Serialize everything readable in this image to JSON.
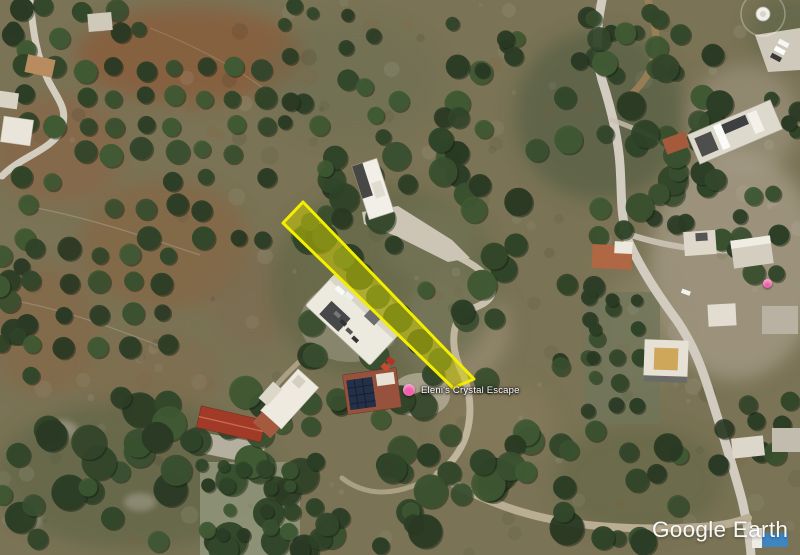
{
  "watermark": {
    "text": "Google Earth"
  },
  "labels": {
    "property": {
      "text": "Eleni's Crystal Escape",
      "marker_color": "#ee5fa8"
    },
    "secondary_marker": {
      "color": "#ee5fa8"
    }
  },
  "parcel": {
    "description": "yellow highlighted land plot",
    "fill": "#d6d400",
    "fill_opacity": "0.5",
    "stroke": "#f4ee00",
    "stroke_width": "3"
  }
}
